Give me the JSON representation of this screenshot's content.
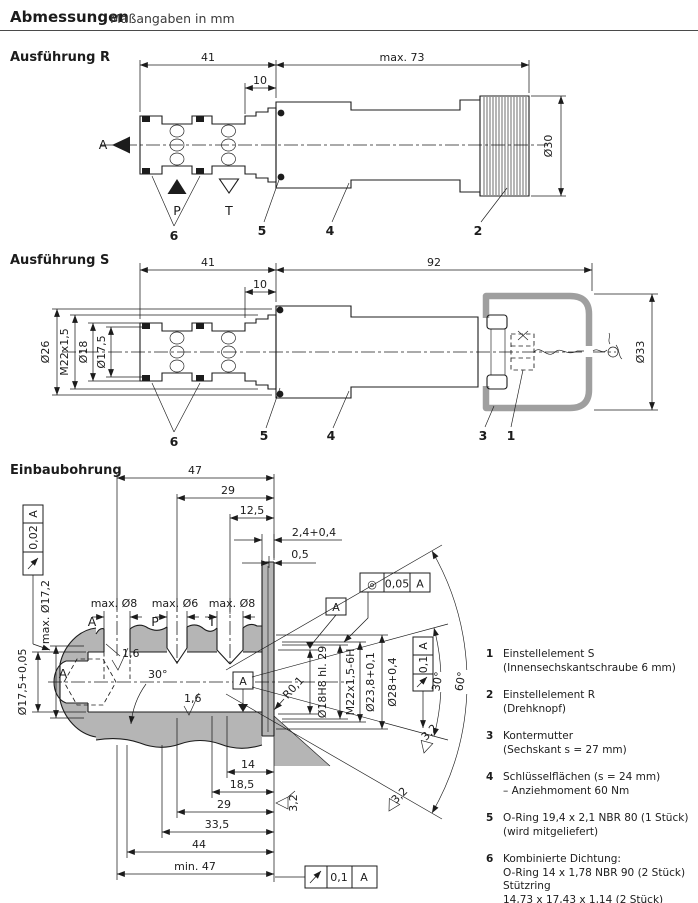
{
  "header": {
    "title": "Abmessungen",
    "subtitle": "Maßangaben in mm"
  },
  "figures": {
    "r": {
      "title": "Ausführung R",
      "dim_41": "41",
      "dim_10": "10",
      "dim_max73": "max. 73",
      "dim_d30": "Ø30",
      "port_a": "A",
      "port_p": "P",
      "port_t": "T",
      "callout_2": "2",
      "callout_4": "4",
      "callout_5": "5",
      "callout_6": "6"
    },
    "s": {
      "title": "Ausführung S",
      "dim_41": "41",
      "dim_10": "10",
      "dim_92": "92",
      "dim_d26": "Ø26",
      "dim_m22": "M22x1,5",
      "dim_d18": "Ø18",
      "dim_d175": "Ø17,5",
      "dim_d33": "Ø33",
      "callout_1": "1",
      "callout_3": "3",
      "callout_4": "4",
      "callout_5": "5",
      "callout_6": "6"
    },
    "bore": {
      "title": "Einbaubohrung",
      "fcf_left": {
        "symbol": "↗",
        "tol": "0,02",
        "datum": "A"
      },
      "fcf_concentric": {
        "symbol": "◎",
        "tol": "0,05",
        "datum": "A"
      },
      "fcf_right": {
        "symbol": "↗",
        "tol": "0,1",
        "datum": "A"
      },
      "fcf_bottom": {
        "symbol": "↗",
        "tol": "0,1",
        "datum": "A"
      },
      "datum_flag_a1": "A",
      "datum_flag_a2": "A",
      "axis_label": "A",
      "dim_47": "47",
      "dim_29_top": "29",
      "dim_125": "12,5",
      "dim_24": "2,4+0,4",
      "dim_05": "0,5",
      "dim_max_d8_a": "max. Ø8",
      "dim_max_d6": "max. Ø6",
      "dim_max_d8_t": "max. Ø8",
      "port_a": "A",
      "port_p": "P",
      "port_t": "T",
      "dim_max_d172": "max. Ø17,2",
      "dim_d175": "Ø17,5+0,05",
      "dim_d18h8": "Ø18H8 hl. 29",
      "dim_m22": "M22x1,5-6H",
      "dim_d238": "Ø23,8+0,1",
      "dim_d28": "Ø28+0,4",
      "dim_r01": "R0,1",
      "angle_chamfer": "30°",
      "angle_30": "30°",
      "angle_60": "60°",
      "rough_16_a": "1,6",
      "rough_16_b": "1,6",
      "rough_32_a": "3,2",
      "rough_32_b": "3,2",
      "rough_32_c": "3,2",
      "dim_14": "14",
      "dim_185": "18,5",
      "dim_29_bot": "29",
      "dim_335": "33,5",
      "dim_44": "44",
      "dim_min47": "min. 47"
    }
  },
  "legend": {
    "items": [
      {
        "num": "1",
        "lines": [
          "Einstellelement S",
          "(Innensechskantschraube 6 mm)"
        ]
      },
      {
        "num": "2",
        "lines": [
          "Einstellelement R",
          "(Drehknopf)"
        ]
      },
      {
        "num": "3",
        "lines": [
          "Kontermutter",
          "(Sechskant s = 27 mm)"
        ]
      },
      {
        "num": "4",
        "lines": [
          "Schlüsselflächen (s = 24 mm)",
          "– Anziehmoment 60 Nm"
        ]
      },
      {
        "num": "5",
        "lines": [
          "O-Ring 19,4 x 2,1 NBR 80 (1 Stück)",
          "(wird mitgeliefert)"
        ]
      },
      {
        "num": "6",
        "lines": [
          "Kombinierte Dichtung:",
          "O-Ring 14 x 1,78 NBR 90 (2 Stück)",
          "Stützring",
          "14,73 x 17,43 x 1,14 (2 Stück)",
          "(wird mitgeliefert)"
        ]
      }
    ]
  },
  "colors": {
    "line": "#1c1c1c",
    "section_fill": "#b5b5b5",
    "cap_gray": "#9f9f9f"
  }
}
